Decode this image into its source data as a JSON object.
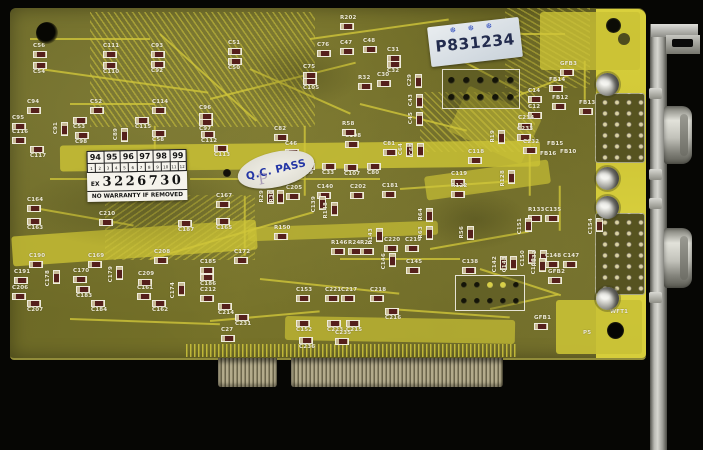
{
  "stickers": {
    "warranty": {
      "years": [
        "94",
        "95",
        "96",
        "97",
        "98",
        "99"
      ],
      "months": [
        "1",
        "2",
        "3",
        "4",
        "5",
        "6",
        "7",
        "8",
        "9",
        "10",
        "11",
        "12"
      ],
      "serial_prefix": "EX",
      "serial_number": "3226730",
      "warning_text": "NO WARRANTY IF REMOVED"
    },
    "qc_pass": {
      "text": "Q.C. PASS",
      "stamp_letter": "P"
    },
    "serial_label": {
      "text": "P831234",
      "marks": "❆ ❆ ❆"
    }
  },
  "colors": {
    "pcb_green": "#6e6a27",
    "trace_yellow": "#c9c135",
    "strip_yellow": "#d6cd3b",
    "silkscreen": "#f0ecd9",
    "sticker_white": "#f5f3ec",
    "qc_blue": "#2335a5",
    "stamp_ink": "#232c4e"
  },
  "board": {
    "components": [
      {
        "l": "C56",
        "x": 33,
        "y": 44
      },
      {
        "l": "C54",
        "x": 33,
        "y": 62,
        "b": 1
      },
      {
        "l": "C111",
        "x": 103,
        "y": 44
      },
      {
        "l": "C110",
        "x": 103,
        "y": 62,
        "b": 1
      },
      {
        "l": "C93",
        "x": 151,
        "y": 44
      },
      {
        "l": "C92",
        "x": 151,
        "y": 61,
        "b": 1
      },
      {
        "l": "C51",
        "x": 228,
        "y": 41
      },
      {
        "l": "C50",
        "x": 228,
        "y": 58,
        "b": 1
      },
      {
        "l": "R202",
        "x": 340,
        "y": 16
      },
      {
        "l": "C76",
        "x": 317,
        "y": 43
      },
      {
        "l": "C47",
        "x": 340,
        "y": 41
      },
      {
        "l": "C48",
        "x": 363,
        "y": 39
      },
      {
        "l": "C31",
        "x": 387,
        "y": 48
      },
      {
        "l": "C32",
        "x": 387,
        "y": 61,
        "b": 1
      },
      {
        "l": "C75",
        "x": 303,
        "y": 65
      },
      {
        "l": "C105",
        "x": 303,
        "y": 78,
        "b": 1
      },
      {
        "l": "R32",
        "x": 358,
        "y": 76
      },
      {
        "l": "C30",
        "x": 377,
        "y": 73
      },
      {
        "l": "C29",
        "x": 408,
        "y": 74,
        "v": 1
      },
      {
        "l": "C43",
        "x": 409,
        "y": 94,
        "v": 1
      },
      {
        "l": "C45",
        "x": 409,
        "y": 112,
        "v": 1
      },
      {
        "l": "C94",
        "x": 27,
        "y": 100
      },
      {
        "l": "C95",
        "x": 12,
        "y": 116
      },
      {
        "l": "C116",
        "x": 12,
        "y": 130
      },
      {
        "l": "C117",
        "x": 30,
        "y": 146,
        "b": 1
      },
      {
        "l": "C91",
        "x": 54,
        "y": 122,
        "v": 1
      },
      {
        "l": "C52",
        "x": 90,
        "y": 100
      },
      {
        "l": "C53",
        "x": 73,
        "y": 117,
        "b": 1
      },
      {
        "l": "C98",
        "x": 75,
        "y": 132,
        "b": 1
      },
      {
        "l": "C89",
        "x": 114,
        "y": 128,
        "v": 1
      },
      {
        "l": "C114",
        "x": 152,
        "y": 100
      },
      {
        "l": "C115",
        "x": 135,
        "y": 117,
        "b": 1
      },
      {
        "l": "C58",
        "x": 152,
        "y": 130,
        "b": 1
      },
      {
        "l": "C96",
        "x": 199,
        "y": 106
      },
      {
        "l": "C97",
        "x": 199,
        "y": 119,
        "b": 1
      },
      {
        "l": "C112",
        "x": 201,
        "y": 131,
        "b": 1
      },
      {
        "l": "C113",
        "x": 214,
        "y": 145,
        "b": 1
      },
      {
        "l": "C82",
        "x": 274,
        "y": 127
      },
      {
        "l": "C46",
        "x": 285,
        "y": 142
      },
      {
        "l": "C108",
        "x": 345,
        "y": 134
      },
      {
        "l": "C81",
        "x": 383,
        "y": 142
      },
      {
        "l": "R58",
        "x": 342,
        "y": 122
      },
      {
        "l": "C49",
        "x": 301,
        "y": 163,
        "b": 1
      },
      {
        "l": "C33",
        "x": 322,
        "y": 163,
        "b": 1
      },
      {
        "l": "C107",
        "x": 344,
        "y": 164,
        "b": 1
      },
      {
        "l": "C80",
        "x": 367,
        "y": 163,
        "b": 1
      },
      {
        "l": "C64",
        "x": 399,
        "y": 143,
        "v": 1
      },
      {
        "l": "C65",
        "x": 410,
        "y": 143,
        "v": 1
      },
      {
        "l": "C118",
        "x": 468,
        "y": 150
      },
      {
        "l": "R19",
        "x": 491,
        "y": 130,
        "v": 1
      },
      {
        "l": "C119",
        "x": 451,
        "y": 172
      },
      {
        "l": "R122",
        "x": 451,
        "y": 184
      },
      {
        "l": "R128",
        "x": 501,
        "y": 170,
        "v": 1
      },
      {
        "l": "C14",
        "x": 528,
        "y": 89
      },
      {
        "l": "C12",
        "x": 528,
        "y": 105
      },
      {
        "l": "C234",
        "x": 518,
        "y": 116
      },
      {
        "l": "C233",
        "x": 517,
        "y": 127
      },
      {
        "l": "C232",
        "x": 523,
        "y": 140
      },
      {
        "l": "GFB3",
        "x": 560,
        "y": 62
      },
      {
        "l": "FB14",
        "x": 549,
        "y": 78
      },
      {
        "l": "FB12",
        "x": 552,
        "y": 96
      },
      {
        "l": "FB13",
        "x": 579,
        "y": 101
      },
      {
        "l": "FB15",
        "x": 547,
        "y": 142,
        "t": 1
      },
      {
        "l": "FB16",
        "x": 540,
        "y": 152,
        "t": 1
      },
      {
        "l": "FB10",
        "x": 560,
        "y": 150,
        "t": 1
      },
      {
        "l": "C205",
        "x": 286,
        "y": 186
      },
      {
        "l": "C140",
        "x": 317,
        "y": 185
      },
      {
        "l": "C202",
        "x": 350,
        "y": 185
      },
      {
        "l": "C181",
        "x": 382,
        "y": 184
      },
      {
        "l": "C139",
        "x": 312,
        "y": 196,
        "v": 1
      },
      {
        "l": "R148",
        "x": 324,
        "y": 202,
        "v": 1
      },
      {
        "l": "R29",
        "x": 260,
        "y": 190,
        "v": 1
      },
      {
        "l": "R30",
        "x": 270,
        "y": 190,
        "v": 1
      },
      {
        "l": "C167",
        "x": 216,
        "y": 194
      },
      {
        "l": "C165",
        "x": 216,
        "y": 218,
        "b": 1
      },
      {
        "l": "C187",
        "x": 178,
        "y": 220,
        "b": 1
      },
      {
        "l": "C210",
        "x": 99,
        "y": 212
      },
      {
        "l": "C164",
        "x": 27,
        "y": 198
      },
      {
        "l": "C163",
        "x": 27,
        "y": 218,
        "b": 1
      },
      {
        "l": "R150",
        "x": 274,
        "y": 226
      },
      {
        "l": "R133",
        "x": 528,
        "y": 208
      },
      {
        "l": "C135",
        "x": 545,
        "y": 208
      },
      {
        "l": "C151",
        "x": 518,
        "y": 218,
        "v": 1
      },
      {
        "l": "C154",
        "x": 589,
        "y": 218,
        "v": 1
      },
      {
        "l": "C150",
        "x": 521,
        "y": 250,
        "v": 1
      },
      {
        "l": "R132",
        "x": 533,
        "y": 250,
        "v": 1
      },
      {
        "l": "C148",
        "x": 545,
        "y": 254
      },
      {
        "l": "C147",
        "x": 563,
        "y": 254
      },
      {
        "l": "GFB2",
        "x": 548,
        "y": 270
      },
      {
        "l": "C190",
        "x": 29,
        "y": 254
      },
      {
        "l": "C191",
        "x": 14,
        "y": 270
      },
      {
        "l": "C206",
        "x": 12,
        "y": 286
      },
      {
        "l": "C207",
        "x": 27,
        "y": 300,
        "b": 1
      },
      {
        "l": "C170",
        "x": 73,
        "y": 269
      },
      {
        "l": "C169",
        "x": 88,
        "y": 254
      },
      {
        "l": "C183",
        "x": 76,
        "y": 286,
        "b": 1
      },
      {
        "l": "C184",
        "x": 91,
        "y": 300,
        "b": 1
      },
      {
        "l": "C178",
        "x": 46,
        "y": 270,
        "v": 1
      },
      {
        "l": "C179",
        "x": 109,
        "y": 266,
        "v": 1
      },
      {
        "l": "C208",
        "x": 154,
        "y": 250
      },
      {
        "l": "C209",
        "x": 138,
        "y": 272
      },
      {
        "l": "C161",
        "x": 137,
        "y": 286
      },
      {
        "l": "C162",
        "x": 152,
        "y": 300,
        "b": 1
      },
      {
        "l": "C174",
        "x": 171,
        "y": 282,
        "v": 1
      },
      {
        "l": "C185",
        "x": 200,
        "y": 260
      },
      {
        "l": "C186",
        "x": 200,
        "y": 274,
        "b": 1
      },
      {
        "l": "C212",
        "x": 200,
        "y": 288
      },
      {
        "l": "C214",
        "x": 218,
        "y": 303,
        "b": 1
      },
      {
        "l": "C231",
        "x": 235,
        "y": 314,
        "b": 1
      },
      {
        "l": "C172",
        "x": 234,
        "y": 250
      },
      {
        "l": "C27",
        "x": 221,
        "y": 328
      },
      {
        "l": "C153",
        "x": 296,
        "y": 288
      },
      {
        "l": "C152",
        "x": 296,
        "y": 320,
        "b": 1
      },
      {
        "l": "C221",
        "x": 325,
        "y": 288
      },
      {
        "l": "C223",
        "x": 327,
        "y": 320,
        "b": 1
      },
      {
        "l": "C217",
        "x": 341,
        "y": 288
      },
      {
        "l": "C215",
        "x": 346,
        "y": 320,
        "b": 1
      },
      {
        "l": "C218",
        "x": 370,
        "y": 288
      },
      {
        "l": "C216",
        "x": 385,
        "y": 308,
        "b": 1
      },
      {
        "l": "C235",
        "x": 335,
        "y": 331
      },
      {
        "l": "C236",
        "x": 299,
        "y": 337,
        "b": 1
      },
      {
        "l": "R146",
        "x": 331,
        "y": 241
      },
      {
        "l": "R24",
        "x": 348,
        "y": 241
      },
      {
        "l": "R22",
        "x": 360,
        "y": 241
      },
      {
        "l": "R143",
        "x": 369,
        "y": 228,
        "v": 1
      },
      {
        "l": "C220",
        "x": 384,
        "y": 238
      },
      {
        "l": "C219",
        "x": 405,
        "y": 238
      },
      {
        "l": "R64",
        "x": 419,
        "y": 208,
        "v": 1
      },
      {
        "l": "R63",
        "x": 419,
        "y": 226,
        "v": 1
      },
      {
        "l": "C146",
        "x": 382,
        "y": 253,
        "v": 1
      },
      {
        "l": "C145",
        "x": 406,
        "y": 260
      },
      {
        "l": "R56",
        "x": 460,
        "y": 226,
        "v": 1
      },
      {
        "l": "C138",
        "x": 462,
        "y": 260
      },
      {
        "l": "C142",
        "x": 493,
        "y": 256,
        "v": 1
      },
      {
        "l": "C143",
        "x": 503,
        "y": 256,
        "v": 1
      },
      {
        "l": "C100",
        "x": 532,
        "y": 258,
        "v": 1
      },
      {
        "l": "GFB1",
        "x": 534,
        "y": 316
      },
      {
        "l": "P5",
        "x": 583,
        "y": 331,
        "t": 1
      },
      {
        "l": "WFT1",
        "x": 610,
        "y": 310,
        "t": 1
      }
    ]
  }
}
